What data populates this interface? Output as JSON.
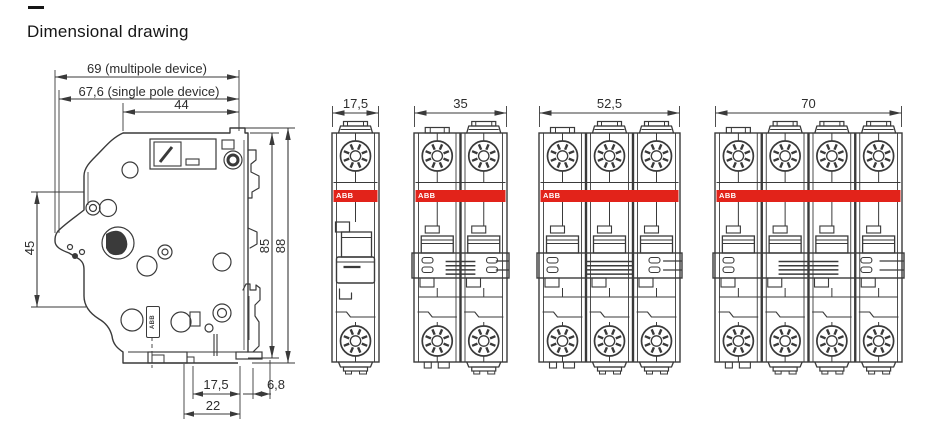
{
  "title": "Dimensional drawing",
  "brand": {
    "label": "ABB",
    "red": "#e2231a"
  },
  "colors": {
    "line": "#3a3a3a",
    "background": "#ffffff",
    "text": "#2d2d2d"
  },
  "side_view": {
    "name": "circuit breaker side view",
    "dims": {
      "overall_multipole": "69 (multipole device)",
      "overall_single_pole": "67,6 (single pole device)",
      "upper_body_depth": "44",
      "front_face_height": "45",
      "housing_height": "85",
      "overall_height": "88",
      "lower_depth": "17,5",
      "din_clip_depth": "6,8",
      "base_depth": "22"
    }
  },
  "front_views": [
    {
      "name": "1-pole breaker front view",
      "poles": 1,
      "width_label": "17,5"
    },
    {
      "name": "2-pole breaker front view",
      "poles": 2,
      "width_label": "35"
    },
    {
      "name": "3-pole breaker front view",
      "poles": 3,
      "width_label": "52,5"
    },
    {
      "name": "4-pole breaker front view",
      "poles": 4,
      "width_label": "70"
    }
  ]
}
